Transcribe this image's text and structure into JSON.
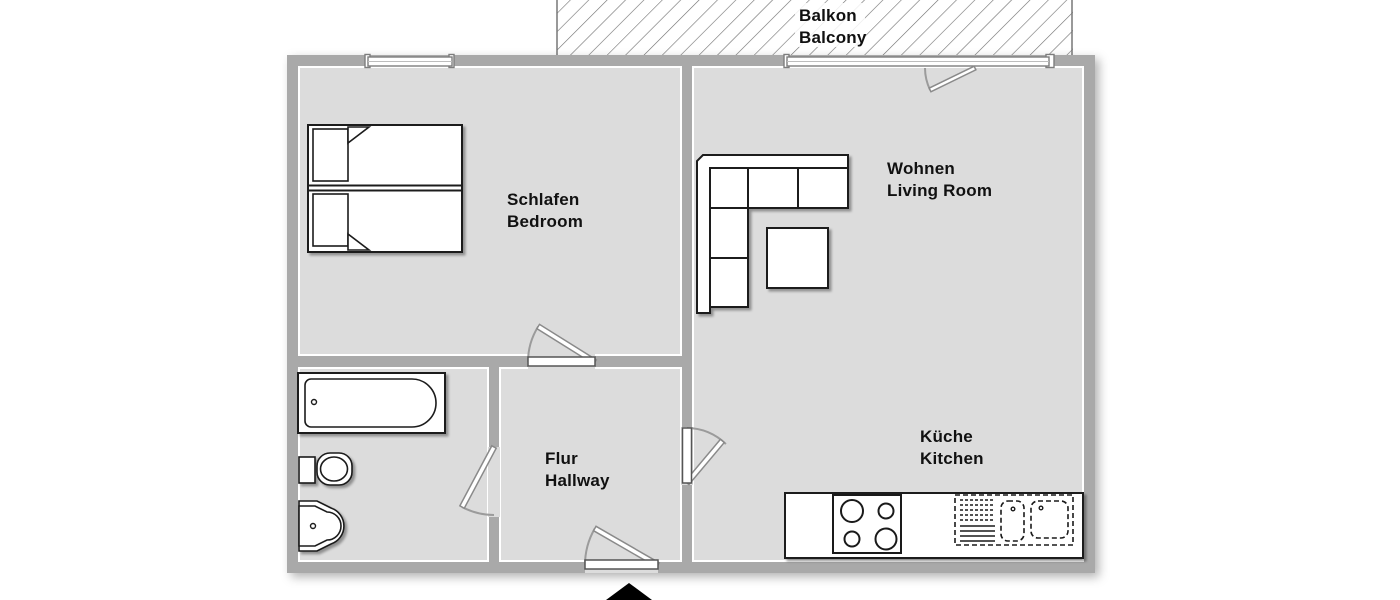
{
  "plan": {
    "type": "apartment-floor-plan",
    "rooms": {
      "balcony": {
        "label_de": "Balkon",
        "label_en": "Balcony"
      },
      "bedroom": {
        "label_de": "Schlafen",
        "label_en": "Bedroom"
      },
      "living_room": {
        "label_de": "Wohnen",
        "label_en": "Living Room"
      },
      "kitchen": {
        "label_de": "Küche",
        "label_en": "Kitchen"
      },
      "hallway": {
        "label_de": "Flur",
        "label_en": "Hallway"
      }
    },
    "colors": {
      "background": "#ffffff",
      "wall": "#a9a9a9",
      "floor": "#dcdcdc",
      "furniture_outline": "#1a1a1a",
      "door_arc": "#9b9b9b",
      "hatch_line": "#6e6e6e",
      "label_text": "#111111",
      "entrance_marker": "#000000"
    }
  }
}
